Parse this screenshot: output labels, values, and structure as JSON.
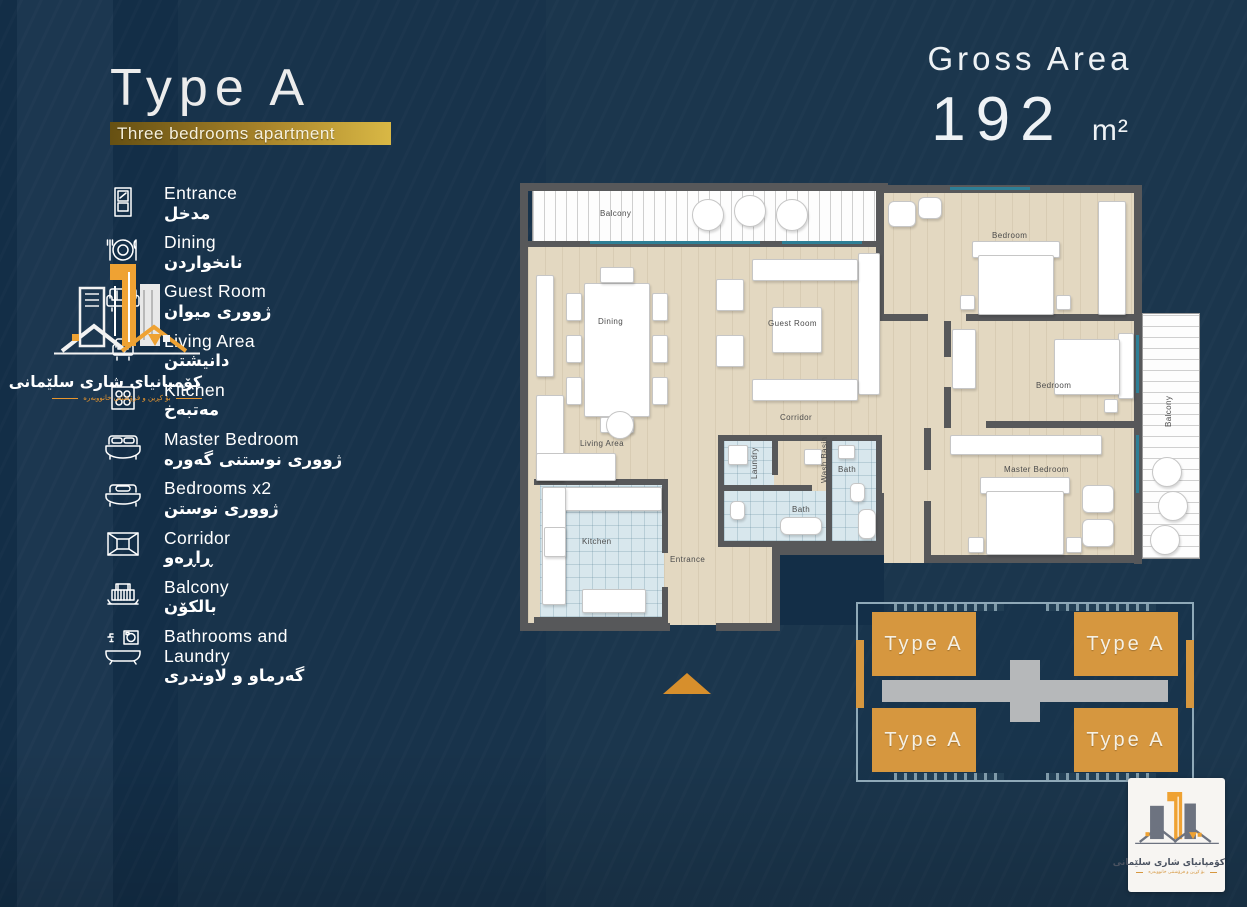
{
  "header": {
    "title": "Type A",
    "subtitle": "Three bedrooms apartment",
    "gross_area_label": "Gross Area",
    "gross_area_value": "192",
    "gross_area_unit": "m²"
  },
  "legend": {
    "items": [
      {
        "en": "Entrance",
        "ku": "مدخل",
        "icon": "door-icon"
      },
      {
        "en": "Dining",
        "ku": "نانخواردن",
        "icon": "dining-icon"
      },
      {
        "en": "Guest Room",
        "ku": "ژووری میوان",
        "icon": "sofa-icon"
      },
      {
        "en": "Living Area",
        "ku": "دانیشتن",
        "icon": "armchair-icon"
      },
      {
        "en": "Kitchen",
        "ku": "مەتبەخ",
        "icon": "stove-icon"
      },
      {
        "en": "Master Bedroom",
        "ku": "ژووری نوستنی گەورە",
        "icon": "double-bed-icon"
      },
      {
        "en": "Bedrooms x2",
        "ku": "ژووری نوستن",
        "icon": "single-bed-icon"
      },
      {
        "en": "Corridor",
        "ku": "ڕاڕەو",
        "icon": "corridor-icon"
      },
      {
        "en": "Balcony",
        "ku": "بالکۆن",
        "icon": "balcony-icon"
      },
      {
        "en": "Bathrooms and Laundry",
        "ku": "گەرماو و لاوندری",
        "icon": "bathtub-icon"
      }
    ]
  },
  "logo": {
    "company_name": "کۆمپانیای شاری سلێمانی",
    "tagline": "بۆ کڕین و فرۆشتنی خانووبەرە"
  },
  "plan": {
    "rooms": {
      "balcony_top": "Balcony",
      "dining": "Dining",
      "guest": "Guest Room",
      "corridor": "Corridor",
      "living": "Living Area",
      "kitchen": "Kitchen",
      "entrance": "Entrance",
      "laundry": "Laundry",
      "wash_basin": "Wash Basin",
      "bath1": "Bath",
      "bath2": "Bath",
      "bedroom1": "Bedroom",
      "bedroom2": "Bedroom",
      "master": "Master Bedroom",
      "balcony_right": "Balcony"
    }
  },
  "footprint": {
    "units": [
      {
        "label": "Type A"
      },
      {
        "label": "Type A"
      },
      {
        "label": "Type A"
      },
      {
        "label": "Type A"
      }
    ]
  },
  "colors": {
    "background": "#132e47",
    "accent_gold": "#c19b2e",
    "unit_orange": "#d6973f",
    "wall_gray": "#57585a",
    "floor_beige": "#e3d8c1",
    "tile_blue": "#d8e7ed",
    "window_teal": "#2e7f96",
    "outline_steel": "#8fa9b8"
  }
}
